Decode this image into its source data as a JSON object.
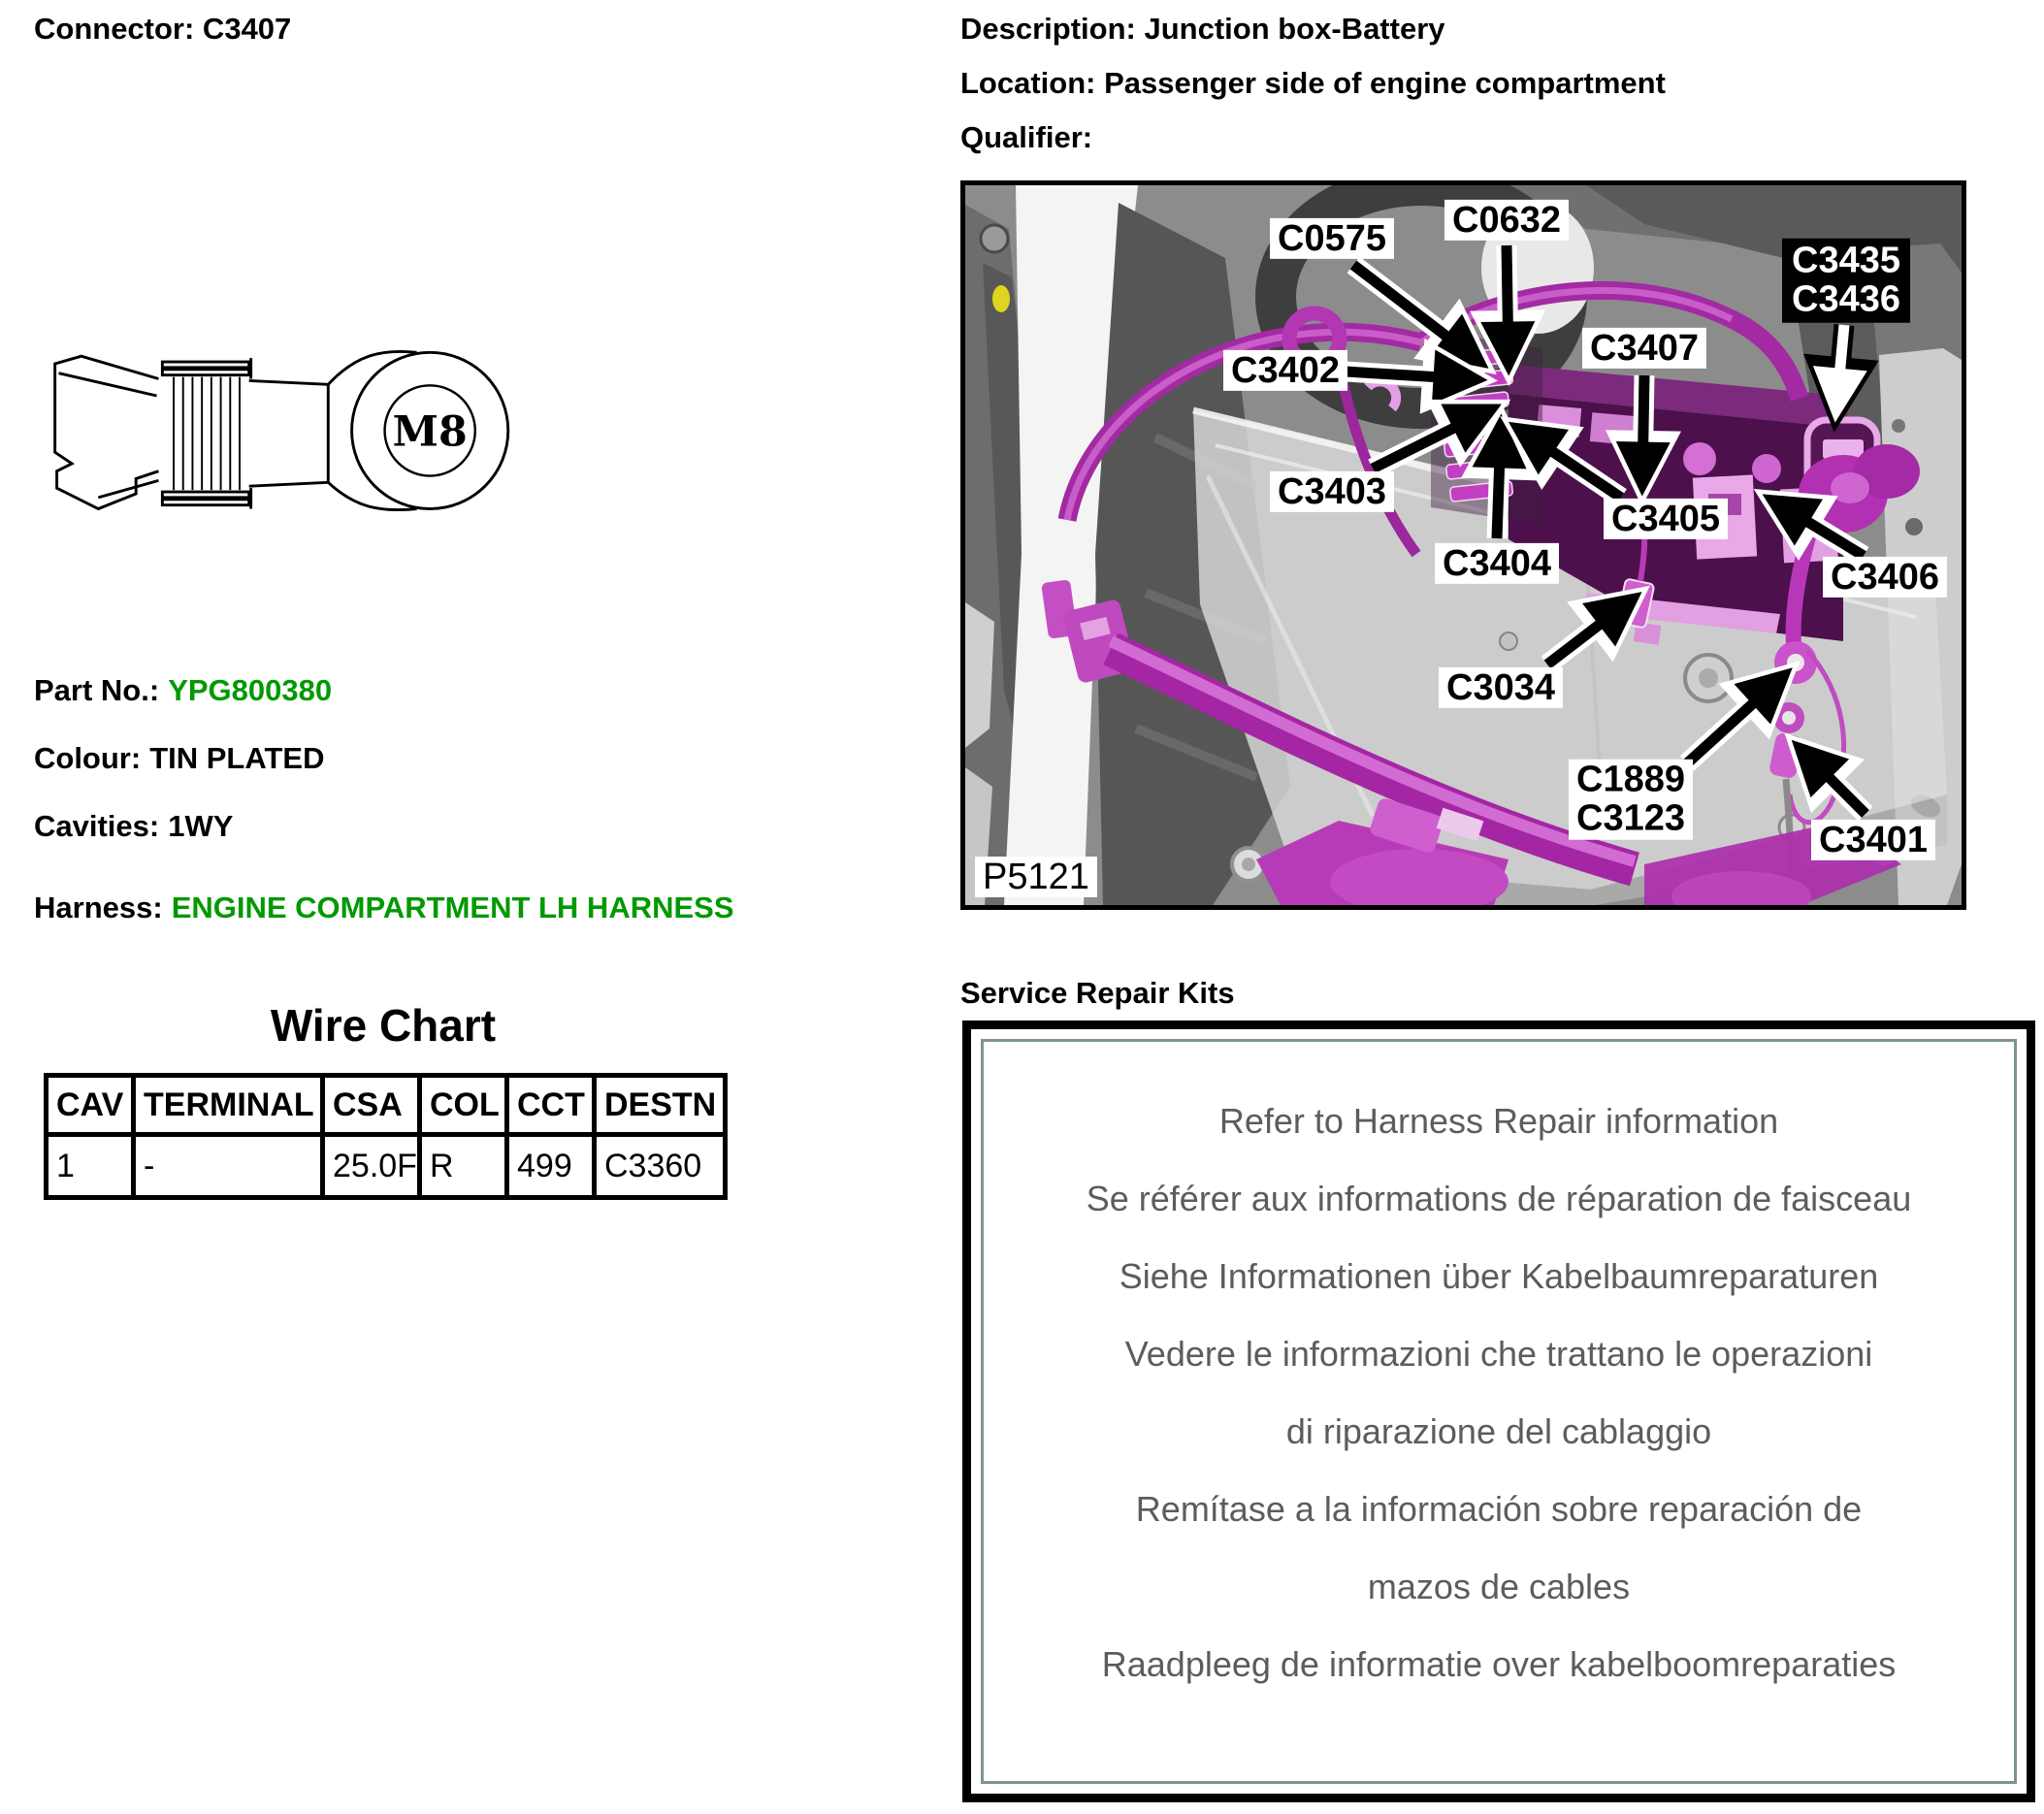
{
  "header": {
    "connector_title": "Connector: C3407",
    "description": "Description: Junction box-Battery",
    "location": "Location: Passenger side of engine compartment",
    "qualifier": "Qualifier:"
  },
  "connector_drawing": {
    "ring_label": "M8"
  },
  "part_info": {
    "part_no_label": "Part No.:",
    "part_no_value": "YPG800380",
    "colour_label": "Colour:",
    "colour_value": "TIN PLATED",
    "cavities_label": "Cavities:",
    "cavities_value": "1WY",
    "harness_label": "Harness:",
    "harness_value": "ENGINE COMPARTMENT LH HARNESS"
  },
  "wire_chart": {
    "title": "Wire Chart",
    "columns": [
      "CAV",
      "TERMINAL",
      "CSA",
      "COL",
      "CCT",
      "DESTN"
    ],
    "rows": [
      [
        "1",
        "-",
        "25.0F",
        "R",
        "499",
        "C3360"
      ]
    ]
  },
  "photo": {
    "callouts": {
      "c0575": "C0575",
      "c0632": "C0632",
      "c3435": "C3435",
      "c3436": "C3436",
      "c3402": "C3402",
      "c3407": "C3407",
      "c3403": "C3403",
      "c3404": "C3404",
      "c3405": "C3405",
      "c3406": "C3406",
      "c3034": "C3034",
      "c1889": "C1889",
      "c3123": "C3123",
      "c3401": "C3401",
      "photo_id": "P5121"
    }
  },
  "service_repair": {
    "title": "Service Repair Kits",
    "lines": [
      "Refer to Harness Repair information",
      "Se référer aux informations de réparation de faisceau",
      "Siehe Informationen über Kabelbaumreparaturen",
      "Vedere le informazioni che trattano le operazioni",
      "di riparazione del cablaggio",
      "Remítase a la información sobre reparación de",
      "mazos de cables",
      "Raadpleeg de informatie over kabelboomreparaties"
    ]
  },
  "colors": {
    "value_green": "#009900",
    "harness_magenta": "#b832b8",
    "junction_box_purple": "#4c104c",
    "repair_border": "#7e9494",
    "repair_text": "#5c5c5c"
  }
}
